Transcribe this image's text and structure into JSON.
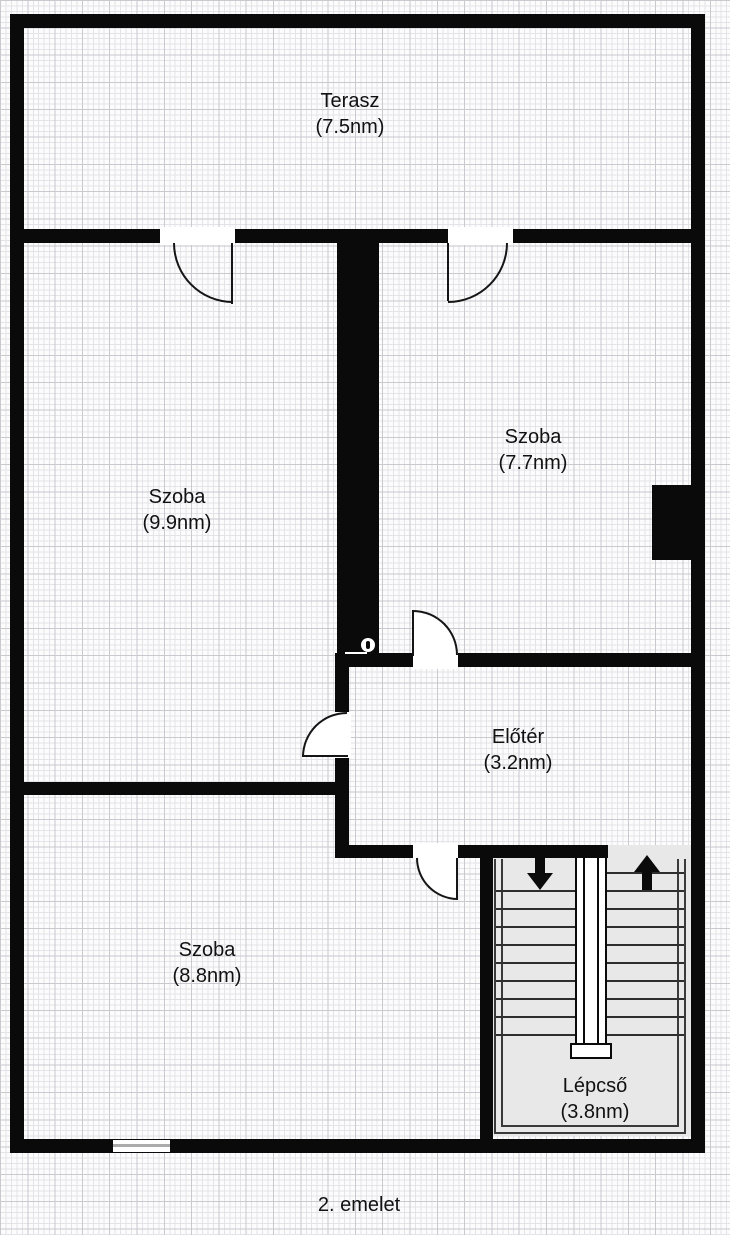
{
  "floor_plan": {
    "floor_label": "2. emelet",
    "rooms": {
      "terasz": {
        "name": "Terasz",
        "area": "(7.5nm)"
      },
      "szoba_left": {
        "name": "Szoba",
        "area": "(9.9nm)"
      },
      "szoba_right": {
        "name": "Szoba",
        "area": "(7.7nm)"
      },
      "eloter": {
        "name": "Előtér",
        "area": "(3.2nm)"
      },
      "szoba_bottom": {
        "name": "Szoba",
        "area": "(8.8nm)"
      },
      "lepcso": {
        "name": "Lépcső",
        "area": "(3.8nm)"
      }
    },
    "stairs": {
      "left_flight": {
        "direction": "down",
        "steps": 9,
        "icon": "down-arrow-icon"
      },
      "right_flight": {
        "direction": "up",
        "steps": 10,
        "icon": "up-arrow-icon"
      }
    },
    "colors": {
      "wall": "#0a0a0a",
      "stair_fill": "#e8e8e8",
      "grid_minor": "#e4e4e8",
      "grid_major": "#c9c9cf",
      "paper": "#fcfcfc"
    }
  }
}
